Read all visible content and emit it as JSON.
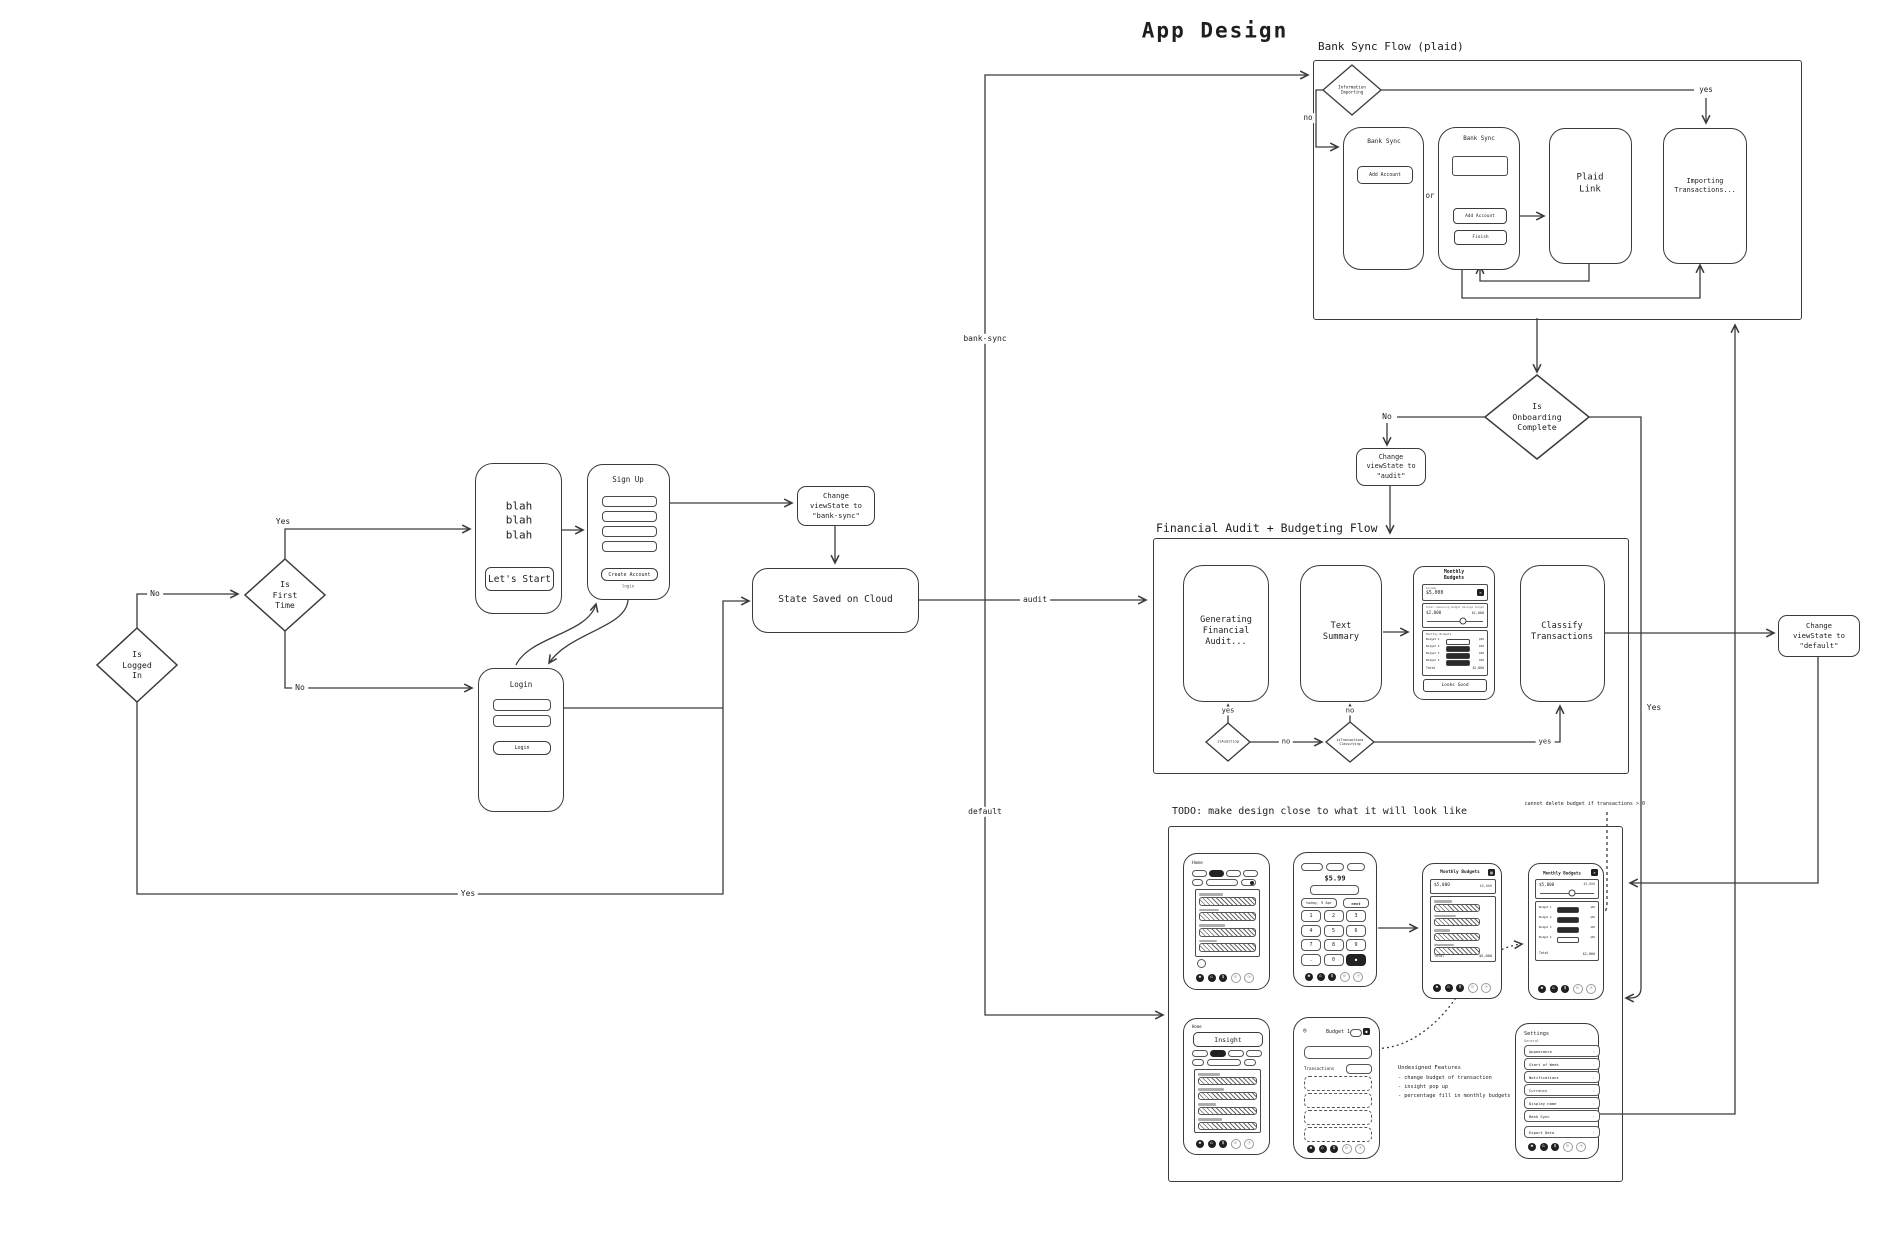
{
  "title": "App Design",
  "icons": {
    "close": "✕",
    "back": "◎",
    "dot": "●",
    "export": "▨"
  },
  "bank_sync": {
    "title": "Bank Sync Flow (plaid)",
    "diamond": "Information\nImporting",
    "no": "no",
    "yes": "yes",
    "or": "or",
    "phone_a": {
      "title": "Bank Sync",
      "add_account": "Add Account"
    },
    "phone_b": {
      "title": "Bank Sync",
      "add_account": "Add Account",
      "finish": "Finish"
    },
    "plaid": "Plaid Link",
    "importing": "Importing\nTransactions..."
  },
  "left": {
    "is_logged_in": "Is\nLogged\nIn",
    "no": "No",
    "yes_bottom": "Yes",
    "is_first_time": "Is\nFirst\nTime",
    "yes": "Yes",
    "no_down": "No",
    "blah": "blah\nblah\nblah",
    "lets_start": "Let's Start",
    "sign_up": {
      "title": "Sign Up",
      "create": "Create Account",
      "login_link": "login"
    },
    "login": {
      "title": "Login",
      "button": "Login"
    },
    "change_banksync": "Change\nviewState to\n\"bank-sync\"",
    "state_saved": "State Saved on Cloud",
    "branch": {
      "bank_sync": "bank-sync",
      "audit": "audit",
      "default": "default"
    }
  },
  "onboarding": {
    "question": "Is\nOnboarding\nComplete",
    "no": "No",
    "yes": "Yes",
    "change_audit": "Change\nviewState to\n\"audit\"",
    "change_default": "Change\nviewState to\n\"default\""
  },
  "financial": {
    "title": "Financial Audit + Budgeting Flow",
    "generating": "Generating\nFinancial\nAudit...",
    "text_summary": "Text\nSummary",
    "classify": "Classify\nTransactions",
    "monthly": {
      "title": "Monthly Budgets",
      "income_label": "Income",
      "income": "$5,000",
      "remaining_label": "Total remaining budget",
      "remaining": "$2,000",
      "savings_label": "Savings target",
      "savings": "$1,000",
      "list_label": "Monthly Budgets",
      "rows": [
        {
          "label": "Budget 1",
          "amount": "$50"
        },
        {
          "label": "Budget 2",
          "amount": "$50"
        },
        {
          "label": "Budget 3",
          "amount": "$50"
        },
        {
          "label": "Budget 4",
          "amount": "$50"
        }
      ],
      "total_label": "Total",
      "total": "$2,000",
      "button": "Looks Good"
    },
    "d_auditing": "isAuditing",
    "d_classifying": "isTransactions\nClassifying",
    "yes_left": "yes",
    "no_mid": "no",
    "no_up": "no",
    "yes_right": "yes"
  },
  "todo": {
    "title": "TODO: make design close to what it will look like",
    "note": "cannot delete budget if transactions > 0",
    "home": {
      "label": "Home"
    },
    "keypad": {
      "amount": "$5.99",
      "date": "today, 9 Apr",
      "next": "next",
      "keys": [
        "1",
        "2",
        "3",
        "4",
        "5",
        "6",
        "7",
        "8",
        "9",
        ".",
        "0",
        "●"
      ]
    },
    "budgets1": {
      "title": "Monthly Budgets",
      "income": "$5,000",
      "income2": "$5,000",
      "total_label": "Total",
      "total": "$5,000"
    },
    "budgets2": {
      "title": "Monthly Budgets",
      "income": "$5,000",
      "income2": "$5,000",
      "rows": [
        {
          "label": "Budget 1",
          "amount": "$50"
        },
        {
          "label": "Budget 2",
          "amount": "$50"
        },
        {
          "label": "Budget 3",
          "amount": "$50"
        },
        {
          "label": "Budget 4",
          "amount": "$50"
        }
      ],
      "total_label": "Total",
      "total": "$2,000"
    },
    "insight": {
      "label": "Home",
      "pill": "Insight"
    },
    "budget_detail": {
      "title": "Budget 1",
      "transactions": "Transactions"
    },
    "undesigned": {
      "title": "Undesigned Features",
      "items": [
        "- change budget of transaction",
        "- insight pop up",
        "- percentage fill in monthly budgets"
      ]
    },
    "settings": {
      "title": "Settings",
      "section": "General",
      "items": [
        "Appearance",
        "Start of Week",
        "Notifications",
        "Currency",
        "Display name",
        "Bank Sync"
      ],
      "export": "Export Data"
    },
    "nav_icons": [
      "✱",
      "⌂",
      "$",
      "⚙",
      "◔"
    ]
  }
}
